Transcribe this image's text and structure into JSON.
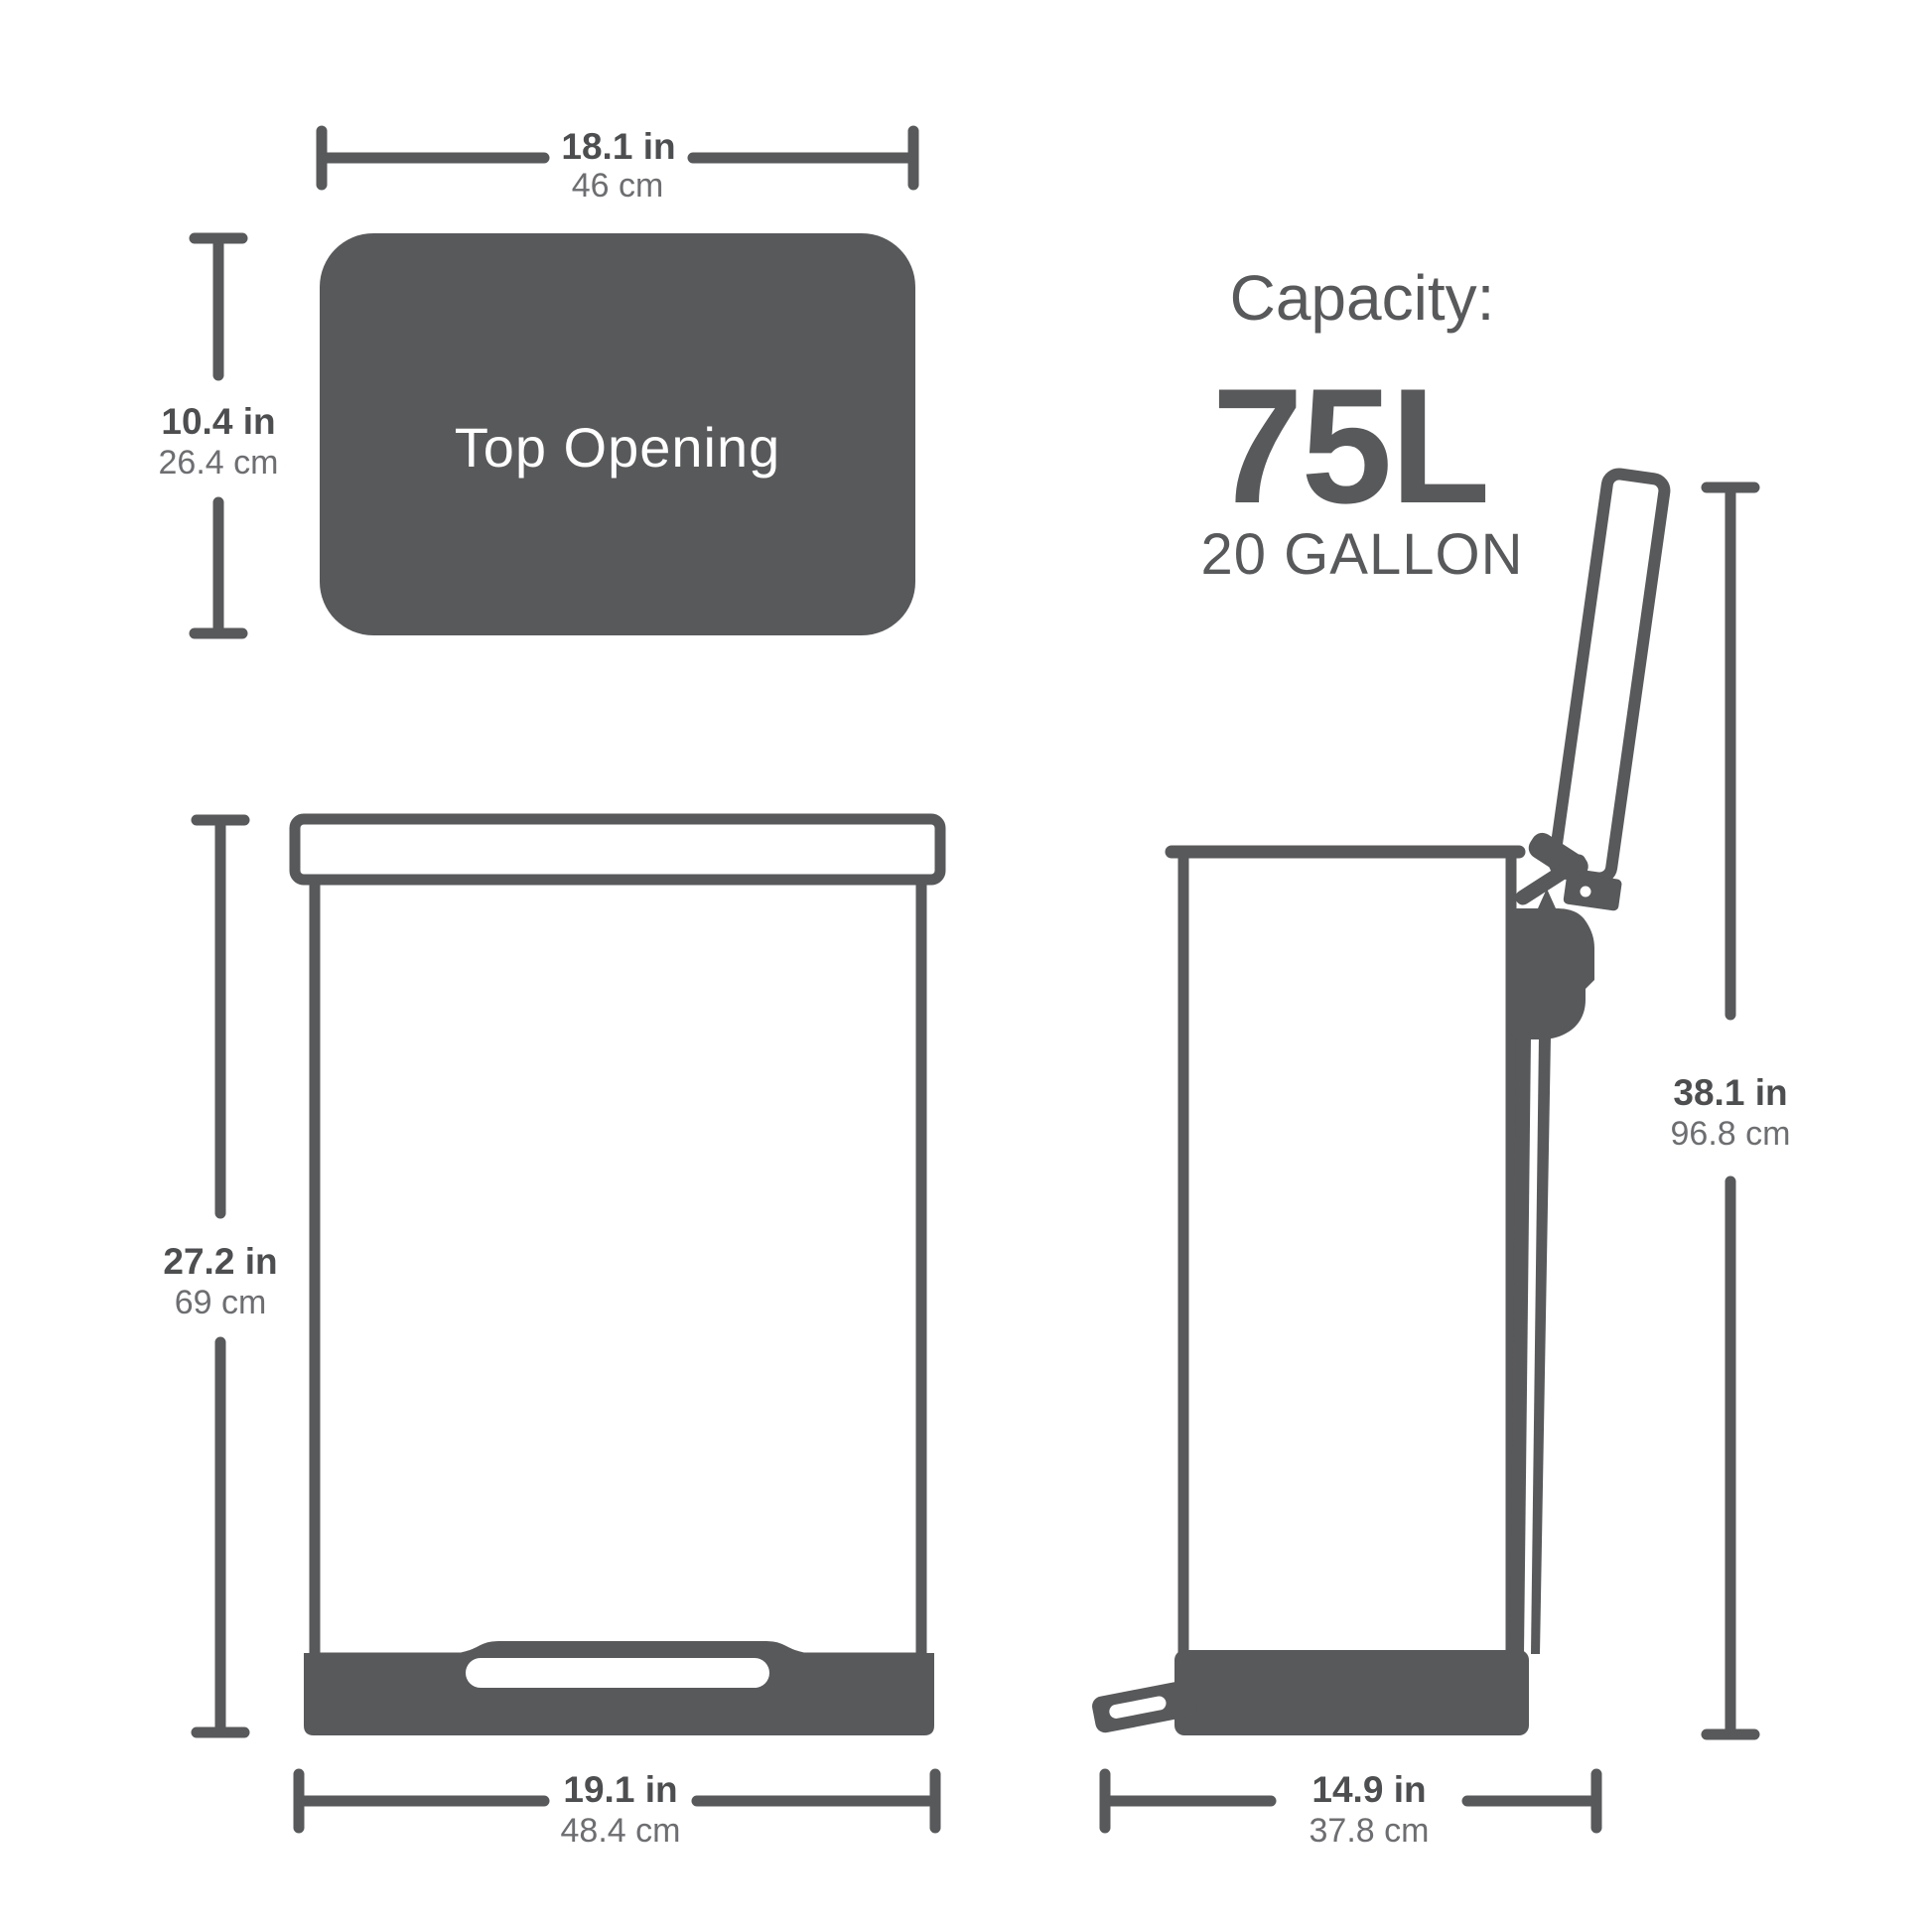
{
  "title": "Trash can product dimensions diagram",
  "colors": {
    "ink": "#58595B",
    "ink_strong": "#4D4E50",
    "ink_soft": "#6D6E71",
    "paper": "#FFFFFF"
  },
  "top_view": {
    "label": "Top Opening",
    "width_dim": {
      "inches": "18.1 in",
      "cm": "46 cm"
    },
    "depth_dim": {
      "inches": "10.4 in",
      "cm": "26.4 cm"
    }
  },
  "capacity": {
    "heading": "Capacity:",
    "liters": "75L",
    "gallons": "20 GALLON"
  },
  "front_view": {
    "height_dim": {
      "inches": "27.2 in",
      "cm": "69 cm"
    },
    "width_dim": {
      "inches": "19.1 in",
      "cm": "48.4 cm"
    }
  },
  "side_view": {
    "height_dim": {
      "inches": "38.1 in",
      "cm": "96.8 cm"
    },
    "depth_dim": {
      "inches": "14.9 in",
      "cm": "37.8 cm"
    }
  }
}
